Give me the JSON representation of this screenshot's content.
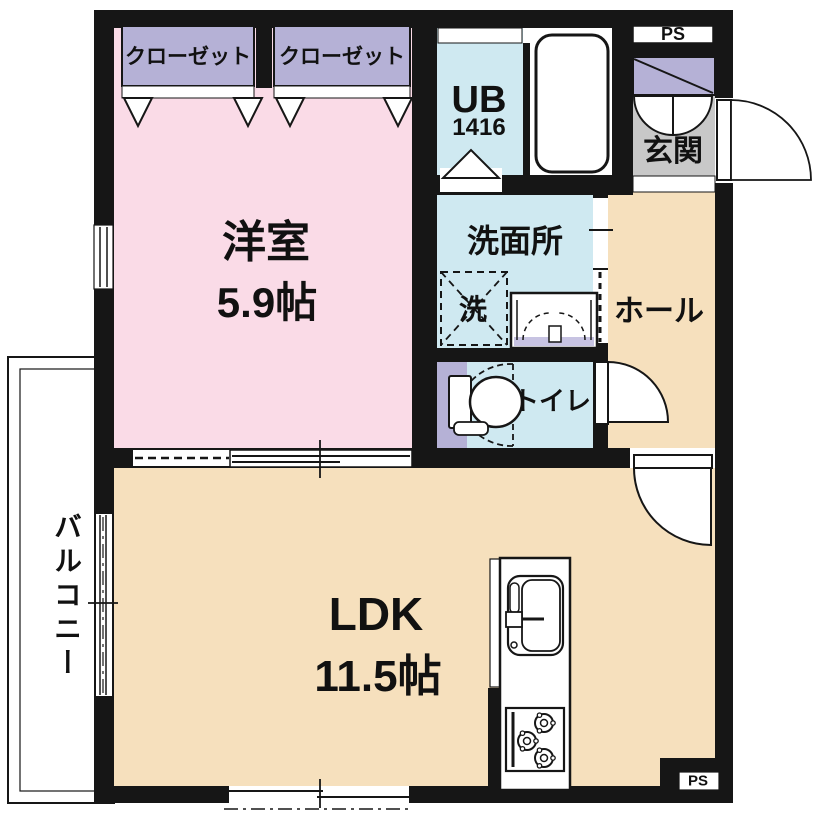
{
  "plan": {
    "closet1_label": "クローゼット",
    "closet2_label": "クローゼット",
    "western_room_label": "洋室",
    "western_room_size": "5.9帖",
    "unit_bath_label": "UB",
    "unit_bath_size": "1416",
    "entrance_label": "玄関",
    "washroom_label": "洗面所",
    "washer_label": "洗",
    "hall_label": "ホール",
    "toilet_label": "トイレ",
    "ldk_label": "LDK",
    "ldk_size": "11.5帖",
    "balcony_label": "バルコニー",
    "pipe_space_top_label": "PS",
    "pipe_space_bottom_label": "PS"
  },
  "colors": {
    "wall": "#161616",
    "western_room": "#fadbe7",
    "room_beige": "#f6e0bd",
    "wet_blue": "#cfe9f1",
    "closet_purple": "#b5b1d6",
    "accent_purple": "#c7c3e2",
    "entrance_gray": "#c8c8c8"
  }
}
